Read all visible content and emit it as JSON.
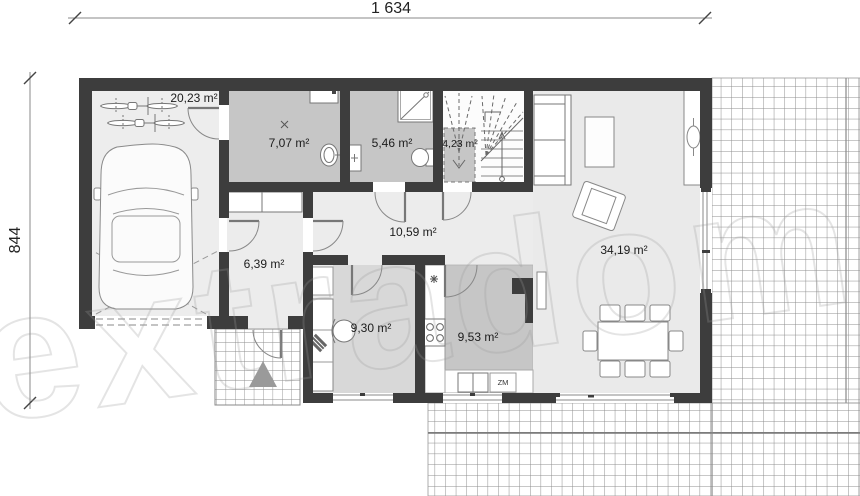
{
  "drawing": {
    "type": "floor-plan",
    "dimensions": {
      "width_label": "1 634",
      "depth_label": "844"
    },
    "rooms": [
      {
        "name": "garage",
        "area": "20,23 m²"
      },
      {
        "name": "utility",
        "area": "7,07 m²"
      },
      {
        "name": "bathroom",
        "area": "5,46 m²"
      },
      {
        "name": "stair-void",
        "area": "4,23 m²"
      },
      {
        "name": "hall",
        "area": "10,59 m²"
      },
      {
        "name": "entry",
        "area": "6,39 m²"
      },
      {
        "name": "office",
        "area": "9,30 m²"
      },
      {
        "name": "kitchen",
        "area": "9,53 m²"
      },
      {
        "name": "living-dining",
        "area": "34,19 m²"
      }
    ],
    "labels": {
      "dishwasher": "ZM"
    },
    "watermark": {
      "text": "extradom"
    },
    "colors": {
      "wall": "#3d3d3d",
      "room_gray": "#c6c6c6",
      "floor_light": "#ececec",
      "office_gray": "#d8d8d8",
      "triangle_gray": "#9a9a9a",
      "grid_line": "#8e8e8e"
    }
  }
}
